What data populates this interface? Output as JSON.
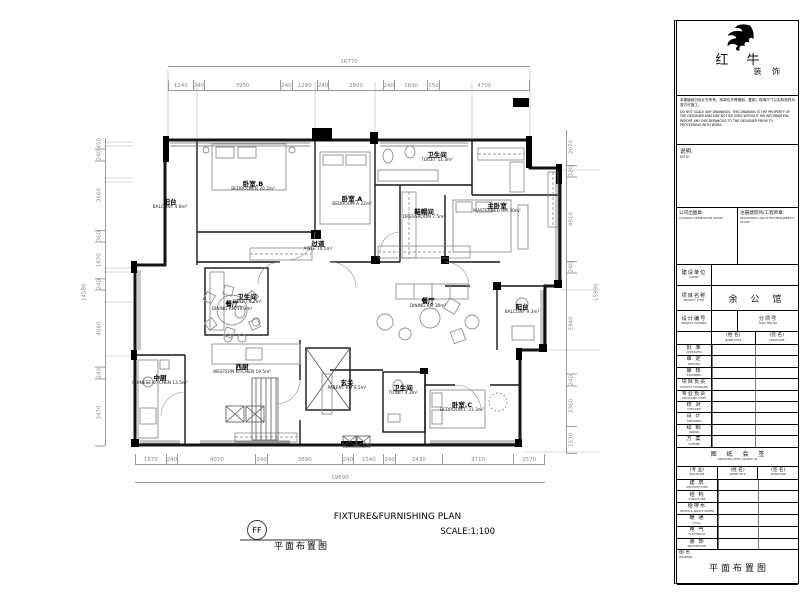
{
  "plan": {
    "rooms": [
      {
        "id": "balcony-b",
        "cn": "阳台",
        "en": "BALCONY 4.6m²"
      },
      {
        "id": "bedroom-b",
        "cn": "卧室.B",
        "en": "BEDROOM.B 20.2m²"
      },
      {
        "id": "toilet-b",
        "cn": "卫生间",
        "en": "TOILET 4.2m²"
      },
      {
        "id": "bedroom-a",
        "cn": "卧室.A",
        "en": "BEDROOM A 22m²"
      },
      {
        "id": "aisle",
        "cn": "过道",
        "en": "AISLE 10.5m²"
      },
      {
        "id": "toilet-master",
        "cn": "卫生间",
        "en": "TOILET 11.3m²"
      },
      {
        "id": "dressroom",
        "cn": "鞋帽间",
        "en": "DRESSROOM 7.5m²"
      },
      {
        "id": "master-bedroom",
        "cn": "主卧室",
        "en": "MASTERBED RM 30m²"
      },
      {
        "id": "dining-west",
        "cn": "餐厅",
        "en": "DINING RM 19.3m²"
      },
      {
        "id": "dining-main",
        "cn": "餐厅",
        "en": "DINING RM 30m²"
      },
      {
        "id": "balcony-main",
        "cn": "阳台",
        "en": "BALCONY 9.3m²"
      },
      {
        "id": "western-kitchen",
        "cn": "西厨",
        "en": "WESTERN KITCHEN 19.5m²"
      },
      {
        "id": "chinese-kitchen",
        "cn": "中厨",
        "en": "CHINESE KITCHEN 13.5m²"
      },
      {
        "id": "foyer",
        "cn": "玄关",
        "en": "PARENT RM 6.5m²"
      },
      {
        "id": "toilet-c",
        "cn": "卫生间",
        "en": "TOILET 4.3m²"
      },
      {
        "id": "bedroom-c",
        "cn": "卧室.C",
        "en": "BEDROOM.C 21.3m²"
      }
    ],
    "dims": {
      "top_overall": "16770",
      "top": [
        "1240",
        "240",
        "3950",
        "240",
        "1280",
        "240",
        "2800",
        "240",
        "1690",
        "150",
        "4700"
      ],
      "bottom_overall": "19690",
      "bottom": [
        "1570",
        "240",
        "4070",
        "240",
        "3890",
        "240",
        "1540",
        "240",
        "2430",
        "3710",
        "1570"
      ],
      "left_overall": "14580",
      "left": [
        "450",
        "240",
        "3660",
        "360",
        "1870",
        "240",
        "4060",
        "240",
        "3470"
      ],
      "right_overall": "15990",
      "right": [
        "2070",
        "320",
        "4910",
        "240",
        "5940",
        "240",
        "2360",
        "1530"
      ]
    },
    "title": {
      "symbol": "FF",
      "cn": "平面布置图",
      "en": "FIXTURE&FURNISHING PLAN",
      "scale": "SCALE:1:100"
    }
  },
  "titleblock": {
    "brand": {
      "name": "红 牛",
      "sub": "装 饰"
    },
    "disclaimer_cn": "本图版权归设计方所有，别单位不得借用、复制，现场尺寸以实际放样为准方可施工。",
    "disclaimer_en": "DO NOT SCALE ANY DRAWINGS. THIS DRAWING IS THE PROPERTY OF THE DESIGNER AND MAY NOT BE USED WITHOUT HIS INFORMATION. REPORT ANY DISCREPANCIES TO THE DESIGNER PRIOR TO PROCEEDING WITH WORK.",
    "note": {
      "cn": "说明:",
      "en": "NOTE"
    },
    "stamps": {
      "company_cn": "公司出图章:",
      "company_en": "COMPANY PERMISSION STAMP",
      "arch_cn": "注册建筑师/工程师章:",
      "arch_en": "REGISTERED ARCHITECT/ENGINEER'S STAMP"
    },
    "client": {
      "cn": "建设单位",
      "en": "CLIENT",
      "value": ""
    },
    "project": {
      "cn": "项目名称",
      "en": "PROJECT TITLE",
      "value": "余 公 馆"
    },
    "design_no": {
      "cn": "设计编号",
      "en": "PROJECT NUMBER",
      "value": ""
    },
    "sub_no": {
      "cn": "分项号",
      "en": "SUB ITEM NO",
      "value": ""
    },
    "sign_header": [
      {
        "cn": "(姓 名)",
        "en": "NAME/TITLE"
      },
      {
        "cn": "(签 名)",
        "en": "SIGNATURE"
      }
    ],
    "sign_rows": [
      {
        "cn": "批 准",
        "en": "APPROVED"
      },
      {
        "cn": "审 定",
        "en": "VERIFIED"
      },
      {
        "cn": "审 核",
        "en": "EXAMINED"
      },
      {
        "cn": "项目负责",
        "en": "PROJECT MANAGER"
      },
      {
        "cn": "专业负责",
        "en": "DISCIPLINE CHIEF"
      },
      {
        "cn": "校 对",
        "en": "CHECKED"
      },
      {
        "cn": "设 计",
        "en": "DESIGNED"
      },
      {
        "cn": "绘 制",
        "en": "DRAWN"
      },
      {
        "cn": "方 案",
        "en": "SCHEME"
      }
    ],
    "joint_sign": {
      "cn": "图 纸 会 签",
      "en": "DRAWING JOINT SIGNED IN"
    },
    "joint_header": [
      {
        "cn": "(专 业)",
        "en": "DISCIPLINE"
      },
      {
        "cn": "(姓 名)",
        "en": "NAME/TITLE"
      },
      {
        "cn": "(签 名)",
        "en": "SIGNATURE"
      }
    ],
    "joint_rows": [
      {
        "cn": "建 筑",
        "en": "ARCHITECTURE"
      },
      {
        "cn": "结 构",
        "en": "STRUCTURE"
      },
      {
        "cn": "给排水",
        "en": "WATER & WASTE WATER"
      },
      {
        "cn": "暖 通",
        "en": "HVAC"
      },
      {
        "cn": "电 气",
        "en": "ELECTRICAL"
      },
      {
        "cn": "装 饰",
        "en": "DECORATION"
      }
    ],
    "drawing_name": {
      "cn": "图 名",
      "en": "DRAWING",
      "value": "平面布置图"
    },
    "footer": {
      "cols": [
        {
          "label": "图 号",
          "en": "DWG NO",
          "value": "1- FF"
        },
        {
          "label": "修改号",
          "en": "MDFN NO",
          "value": ""
        },
        {
          "label": "图档号",
          "en": "FILE NO",
          "value": ""
        },
        {
          "label": "日 期",
          "en": "DATE",
          "value": "18.08.11"
        },
        {
          "label": "版本号",
          "en": "VER NO",
          "value": "A"
        }
      ]
    }
  }
}
